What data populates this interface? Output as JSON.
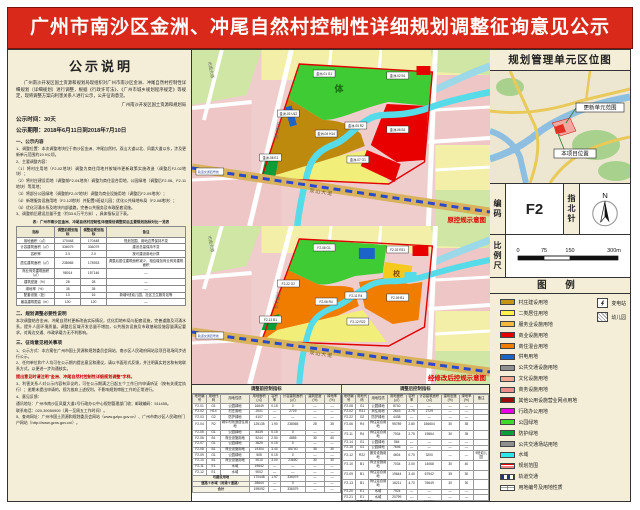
{
  "title": "广州市南沙区金洲、冲尾自然村控制性详细规划调整征询意见公示",
  "left_panel": {
    "heading": "公示说明",
    "intro": "广州南沙开发区国土资源和规划局现组织对广州市南沙区金洲、冲尾自然村控制性详细规划（详细规划）进行调整，根据《行政许可法》、《广州市城乡规划程序规定》等规定，现将调整方案向利害关系人进行公示，公开征询意见。",
    "issuer": "广州南沙开发区国土资源和规划局",
    "time": "公示时间：30天",
    "period": "公示期限：2018年6月11日到2018年7月10日",
    "sec1_title": "一、公示内容",
    "sec1_items": [
      "1、调整位置：本次调整地块位于南沙区金洲、冲尾自然村，双山大道以北、凤凰大道以东，涉及更新单元范围约19.9公顷。",
      "2、主要调整内容：",
      "（1）将村庄用地（F2-02地块）调整为商住用地并按城市更新政策实施改造（调整后F2-02地块）；",
      "（2）将村庄建设用地（调整前F2-04地块）调整为商住混合用地、公园绿地（调整后F2-06、F2-11地块）等用地；",
      "（3）将部分公园绿地（调整前F2-07地块）调整为商业设施用地（调整后F2-09地块）；",
      "（4）新增服务设施用地（F2-12地块）并配置9班幼儿园；优化公共绿地布局（F2-08地块）；",
      "（5）优化河涌水系及地块内部道路，完善公共服务及市政配套设施。",
      "3、调整前后建设总量不变（约33.6万平方米），具体指标见下表。"
    ],
    "table_caption": "表：广州市南沙区金洲、冲尾自然村控制性详细规划调整前后主要规划指标对比一览表",
    "mini_table": {
      "columns": [
        "指标",
        "调整前规划指标",
        "调整后规划指标",
        "备注"
      ],
      "rows": [
        [
          "用地面积（㎡）",
          "170448",
          "170448",
          "规划范围、用地边界保持不变"
        ],
        [
          "计容建筑面积（㎡）",
          "336079",
          "336079",
          "建设总量保持不变"
        ],
        [
          "容积率",
          "2.0",
          "2.0",
          "按可建设用地计算"
        ],
        [
          "居住建筑面积（㎡）",
          "238065",
          "178933",
          "调整后居住建筑面积减少，相应增加商业商务建筑面积"
        ],
        [
          "商业商务建筑面积（㎡）",
          "98014",
          "157146",
          "—"
        ],
        [
          "建筑密度（%）",
          "28",
          "28",
          "—"
        ],
        [
          "绿地率（%）",
          "35",
          "35",
          "—"
        ],
        [
          "配套设施（处）",
          "13",
          "16",
          "新增9班幼儿园、社区卫生服务站等"
        ],
        [
          "最高建筑限高（m）",
          "100",
          "120",
          "—"
        ]
      ]
    },
    "sec2_title": "二、规划调整必要性说明",
    "sec2_items": [
      "本次调整结合金洲、冲尾自然村更新改造实际情况，优化用地布局与配套设施，完善道路及河涌水系，提升人居环境质量。调整后区域开发总量不增加，公共服务设施及市政基础设施容量满足要求，对周边交通、市政承载力无不利影响。"
    ],
    "sec3_title": "三、征询意见相关事项",
    "sec3_items": [
      "1、公示方式：本方案在广州市国土资源和规划委员会网站、南沙区人民政府网站及项目现场同步进行公示。",
      "2、任何单位和个人均可在公示期内提出意见和建议，请以书面形式反馈，并注明真实姓名和有效联系方式，以便进一步沟通核实。"
    ],
    "red_note": "提出意见时请注明“金洲、冲尾自然村控制性详细规划调整”字样。",
    "sec4_items": [
      "3、利害关系人对公示内容有异议的，可在公示期满之日起五个工作日内申请听证（按有关规定执行）；逾期未提出申请的，视为放弃上述权利，不影响规划审批工作的正常进行。",
      "4、意见反馈：",
      "通讯地址：广州市南沙区凤凰大道1号行政办公中心规划管理部门收；邮政编码：511455。",
      "联系电话：020-39050909（周一至周五工作时间）。"
    ],
    "urls": "5、查询网址：广州市国土资源和规划委员会网站（www.gzlpc.gov.cn）、广州市南沙区人民政府门户网站（http://www.gzns.gov.cn/）。"
  },
  "maps": {
    "shared": {
      "road_bottom": "双山大道",
      "road_left": "凤凰大道",
      "road_topleft": "市南大道",
      "rail_label": "轨道交通四号线"
    },
    "top": {
      "corner_label": "原控规示意图",
      "area_mark": "体",
      "labels": [
        "金洲-01 G1",
        "金洲-02 B1",
        "金洲-03 U12",
        "金洲-04 H14",
        "金洲-05 R2",
        "金洲-06 B1",
        "金洲-07 G1",
        "金洲-08 E1"
      ]
    },
    "bottom": {
      "corner_label": "经修改后控规示意图",
      "school_mark": "校",
      "labels": [
        "F2-08 G1",
        "F2-02 R31",
        "F2-22 G2",
        "F2-06 R4",
        "F2-11 R4",
        "F2-09 B1",
        "F2-12 R22",
        "F2-13 B1"
      ]
    }
  },
  "spec_tables": {
    "left_caption": "调整前控制指标",
    "right_caption": "调整后控制指标",
    "columns": [
      "地块编号",
      "用地代码",
      "用地性质",
      "用地面积(㎡)",
      "容积率",
      "计容建筑面积(㎡)",
      "建筑密度(%)",
      "绿地率(%)"
    ],
    "remark_col": [
      "备注"
    ],
    "left_rows": [
      [
        "F2-01",
        "G1",
        "公园绿地",
        "16649",
        "0.15",
        "0",
        "—",
        "—"
      ],
      [
        "F2-02",
        "H14",
        "村庄用地",
        "2001",
        "—",
        "2729",
        "—",
        "—"
      ],
      [
        "F2-03",
        "G2",
        "防护绿地",
        "4107",
        "—",
        "—",
        "—",
        "—"
      ],
      [
        "F2-04",
        "R2",
        "城中村改造居住用地",
        "125135",
        "1.90",
        "238065",
        "28",
        "35"
      ],
      [
        "F2-05",
        "G1",
        "公园绿地",
        "8439",
        "0.15",
        "0",
        "—",
        "—"
      ],
      [
        "F2-06",
        "B1",
        "商业设施用地",
        "5244",
        "2.50",
        "4855",
        "30",
        "40"
      ],
      [
        "F2-07",
        "G1",
        "公园绿地",
        "3625",
        "0.15",
        "0",
        "—",
        "—"
      ],
      [
        "F2-08",
        "B1",
        "商业设施用地",
        "19304",
        "3.40",
        "65740",
        "35",
        "30"
      ],
      [
        "F2-09",
        "G1",
        "公园绿地",
        "505",
        "0.15",
        "0",
        "—",
        "—"
      ],
      [
        "F2-10",
        "B1",
        "商业设施用地",
        "9010",
        "3.00",
        "23690",
        "30",
        "30"
      ],
      [
        "F2-11",
        "E1",
        "水域",
        "19642",
        "—",
        "—",
        "—",
        "—"
      ],
      [
        "F2-12",
        "E1",
        "水域",
        "9002",
        "—",
        "—",
        "—",
        "—"
      ]
    ],
    "left_summary": [
      [
        "可建设用地",
        "170448",
        "1.97",
        "336079",
        "—",
        "—"
      ],
      [
        "道路＋水域（河涌＋道路）",
        "28644",
        "—",
        "0",
        "—",
        "—"
      ],
      [
        "合计",
        "199092",
        "—",
        "336079",
        "—",
        "—"
      ]
    ],
    "right_rows": [
      [
        "F2-08",
        "G1",
        "公园绿地",
        "8740",
        "—",
        "—",
        "—",
        "—",
        ""
      ],
      [
        "F2-02",
        "R31",
        "商住用地",
        "2643",
        "2.75",
        "2729",
        "—",
        "—",
        ""
      ],
      [
        "F2-22",
        "G2",
        "防护绿地",
        "4438",
        "—",
        "—",
        "—",
        "—",
        ""
      ],
      [
        "F2-06",
        "R4",
        "商住混合用地",
        "95789",
        "2.80",
        "156604",
        "30",
        "35",
        ""
      ],
      [
        "F2-11",
        "R4",
        "商住混合用地",
        "7934",
        "2.75",
        "19564",
        "30",
        "35",
        ""
      ],
      [
        "F2-14",
        "G1",
        "公园绿地",
        "564",
        "—",
        "—",
        "—",
        "—",
        ""
      ],
      [
        "F2-15",
        "G1",
        "公园绿地",
        "7646",
        "—",
        "—",
        "—",
        "—",
        ""
      ],
      [
        "F2-12",
        "R22",
        "服务设施用地",
        "4604",
        "0.70",
        "3200",
        "—",
        "—",
        "9班幼儿园"
      ],
      [
        "F2-10",
        "B1",
        "商业设施用地",
        "7034",
        "2.00",
        "14068",
        "30",
        "40",
        ""
      ],
      [
        "F2-09",
        "B1",
        "商住混合用地",
        "19644",
        "3.40",
        "67942",
        "35",
        "30",
        ""
      ],
      [
        "F2-13",
        "B1",
        "商住混合用地",
        "16211",
        "4.70",
        "76649",
        "30",
        "30",
        ""
      ],
      [
        "F2-20",
        "E1",
        "水域",
        "7924",
        "—",
        "—",
        "—",
        "—",
        ""
      ],
      [
        "F2-21",
        "E1",
        "水域",
        "20799",
        "—",
        "—",
        "—",
        "—",
        ""
      ]
    ],
    "right_summary": [
      [
        "可建设用地",
        "167207",
        "2.04",
        "340756",
        "—",
        "—",
        ""
      ],
      [
        "道路＋水域（河涌＋道路）",
        "28723",
        "—",
        "0",
        "—",
        "—",
        ""
      ],
      [
        "合计",
        "195930",
        "—",
        "340756",
        "—",
        "—",
        ""
      ]
    ]
  },
  "right_panel": {
    "location_title": "规划管理单元区位图",
    "map_label_unit": "更新单元范围",
    "map_label_site": "本项目位置",
    "code_label": "编码",
    "code_value": "F2",
    "compass_label": "指北针",
    "compass_n": "N",
    "scale_label": "比例尺",
    "scale_ticks": {
      "t0": "0",
      "t1": "75",
      "t2": "150",
      "t3": "300m"
    },
    "legend_title": "图 例",
    "legend": [
      {
        "label": "村庄建设用地",
        "swatch": "fill",
        "color": "#c99413"
      },
      {
        "label": "二类居住用地",
        "swatch": "fill",
        "color": "#fff24a"
      },
      {
        "label": "服务业设施用地",
        "swatch": "fill",
        "color": "#f5b83d"
      },
      {
        "label": "商业设施用地",
        "swatch": "fill",
        "color": "#e60000"
      },
      {
        "label": "商住混合用地",
        "swatch": "fill",
        "color": "#f07d00"
      },
      {
        "label": "供电用地",
        "swatch": "fill",
        "color": "#1c64c8"
      },
      {
        "label": "公共交通设施用地",
        "swatch": "fill",
        "color": "#8f8f8f"
      },
      {
        "label": "文化设施用地",
        "swatch": "fill",
        "color": "#f2a793"
      },
      {
        "label": "商务设施用地",
        "swatch": "fill",
        "color": "#ee8b8b"
      },
      {
        "label": "其他公用设施营业网点用地",
        "swatch": "fill",
        "color": "#9e0b0f"
      },
      {
        "label": "行政办公用地",
        "swatch": "fill",
        "color": "#ec00ec"
      },
      {
        "label": "公园绿地",
        "swatch": "fill",
        "color": "#3bdb2c"
      },
      {
        "label": "防护绿地",
        "swatch": "fill",
        "color": "#089e3c"
      },
      {
        "label": "公共交通场站用地",
        "swatch": "fill",
        "color": "#8f8f8f"
      },
      {
        "label": "水域",
        "swatch": "fill",
        "color": "#2ee8e8"
      },
      {
        "label": "规划范围",
        "swatch": "stripe",
        "color": ""
      },
      {
        "label": "轨道交通",
        "swatch": "dash",
        "color": ""
      },
      {
        "label": "用地编号及用地性质",
        "swatch": "box",
        "color": ""
      }
    ],
    "legend_icons": [
      {
        "label": "变电站",
        "icon": "substation-icon"
      },
      {
        "label": "幼儿园",
        "icon": "kindergarten-icon"
      }
    ]
  },
  "colors": {
    "banner_red": "#d9291b",
    "panel_beige": "#f4eed8",
    "boundary_red": "#e00000",
    "river_cyan": "#55dce8"
  }
}
